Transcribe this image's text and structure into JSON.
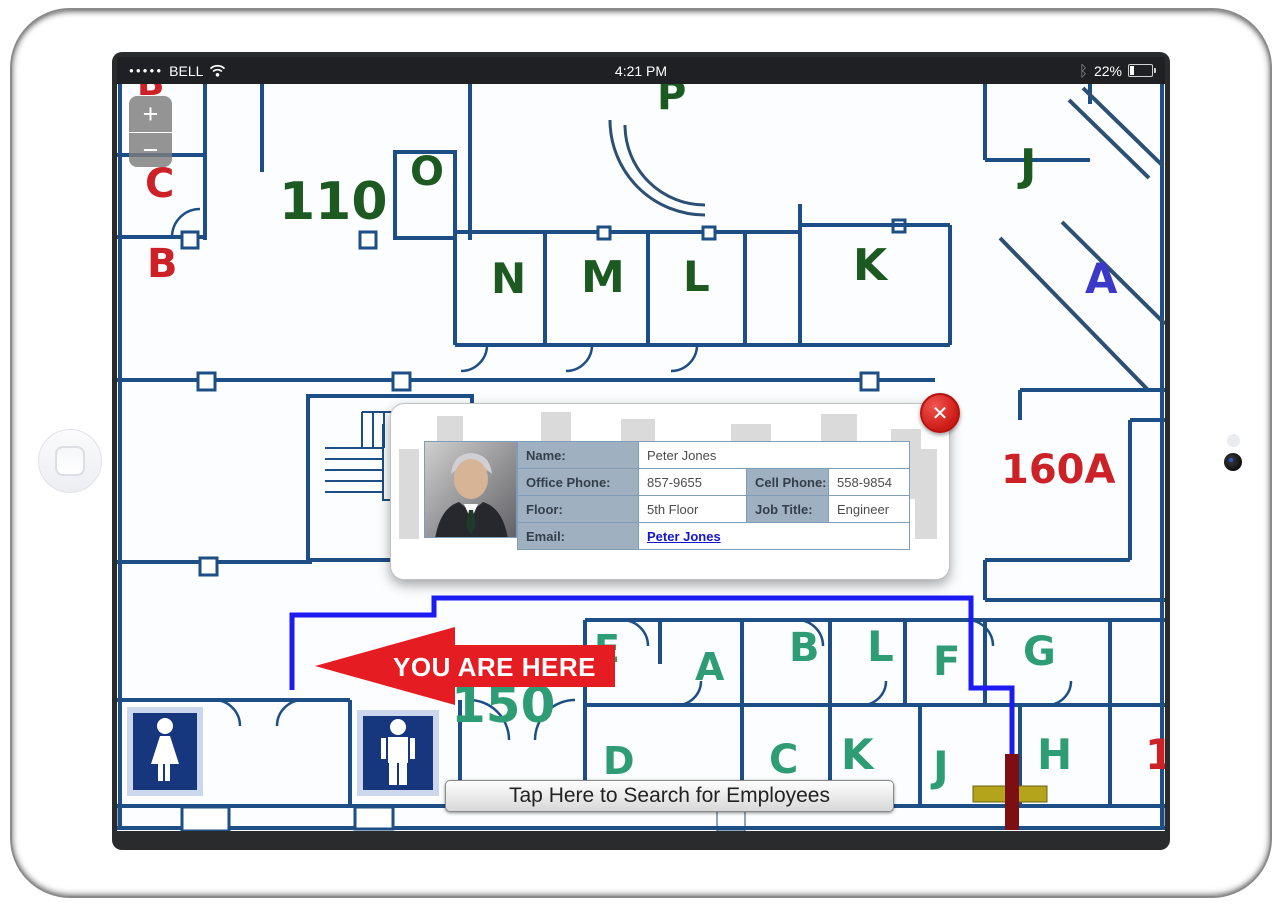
{
  "status_bar": {
    "signal_dots": "●●●●●",
    "carrier": "BELL",
    "time": "4:21 PM",
    "bluetooth_glyph": "ᛒ",
    "battery_percent": "22%"
  },
  "map": {
    "zoom_in_label": "+",
    "zoom_out_label": "−",
    "you_are_here_label": "YOU ARE HERE",
    "search_button_label": "Tap Here to Search for Employees",
    "room_labels": [
      {
        "text": "B",
        "color": "red"
      },
      {
        "text": "C",
        "color": "red"
      },
      {
        "text": "B",
        "color": "red"
      },
      {
        "text": "110",
        "color": "dark-green"
      },
      {
        "text": "O",
        "color": "dark-green"
      },
      {
        "text": "P",
        "color": "dark-green"
      },
      {
        "text": "N",
        "color": "dark-green"
      },
      {
        "text": "M",
        "color": "dark-green"
      },
      {
        "text": "L",
        "color": "dark-green"
      },
      {
        "text": "K",
        "color": "dark-green"
      },
      {
        "text": "J",
        "color": "dark-green"
      },
      {
        "text": "A",
        "color": "blue"
      },
      {
        "text": "160A",
        "color": "red"
      },
      {
        "text": "150",
        "color": "green"
      },
      {
        "text": "E",
        "color": "green"
      },
      {
        "text": "A",
        "color": "green"
      },
      {
        "text": "B",
        "color": "green"
      },
      {
        "text": "L",
        "color": "green"
      },
      {
        "text": "F",
        "color": "green"
      },
      {
        "text": "G",
        "color": "green"
      },
      {
        "text": "D",
        "color": "green"
      },
      {
        "text": "C",
        "color": "green"
      },
      {
        "text": "K",
        "color": "green"
      },
      {
        "text": "J",
        "color": "green"
      },
      {
        "text": "H",
        "color": "green"
      },
      {
        "text": "1",
        "color": "red"
      }
    ]
  },
  "popup": {
    "close_glyph": "✕",
    "rows": {
      "name_label": "Name:",
      "name_value": "Peter Jones",
      "office_phone_label": "Office Phone:",
      "office_phone_value": "857-9655",
      "cell_phone_label": "Cell Phone:",
      "cell_phone_value": "558-9854",
      "floor_label": "Floor:",
      "floor_value": "5th Floor",
      "job_title_label": "Job Title:",
      "job_title_value": "Engineer",
      "email_label": "Email:",
      "email_value": "Peter Jones"
    }
  },
  "theme": {
    "wall": "#1d4e86",
    "route_blue": "#1b1bf2",
    "arrow_red": "#e51c22",
    "dark_green": "#1d5a21",
    "mid_green": "#2e9c74",
    "red_label": "#cc2127",
    "blue_label": "#3d39c8",
    "restroom_blue": "#16377e",
    "label_cell": "#9fb0c0",
    "table_border": "#7f9db9",
    "link_blue": "#1515cc",
    "marker_red": "#7d0e12",
    "marker_gold": "#b3a41c",
    "status_bg": "#1f2023"
  }
}
